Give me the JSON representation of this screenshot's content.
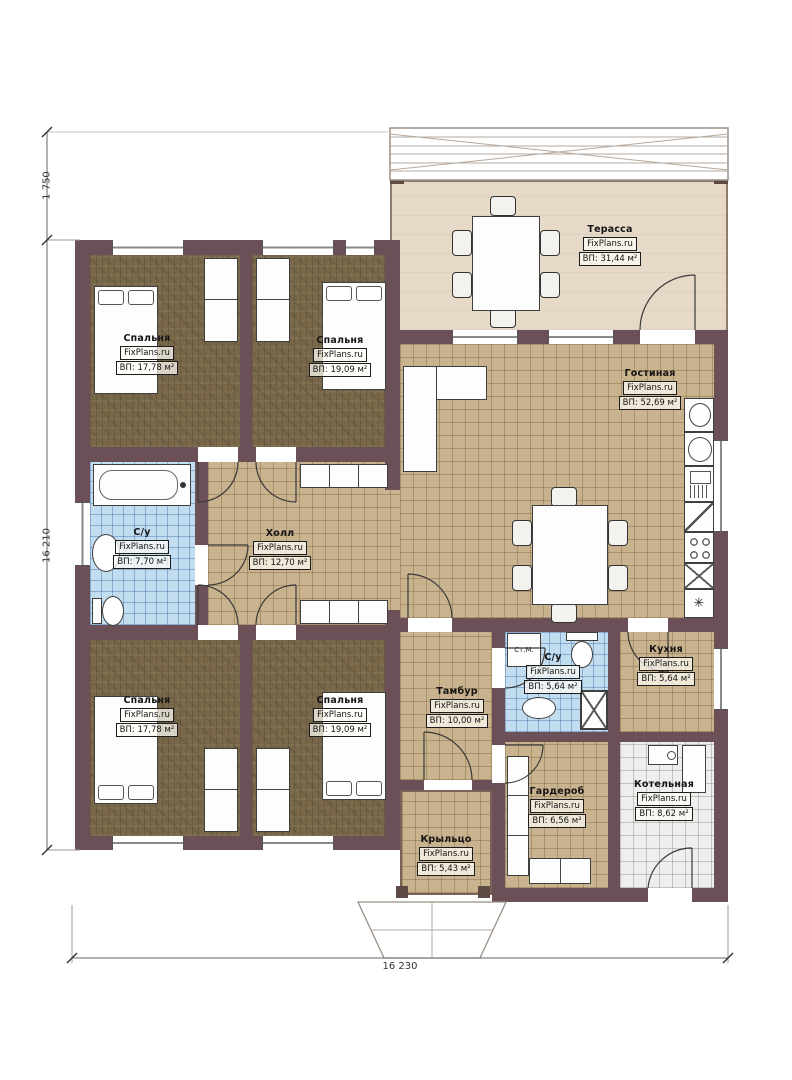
{
  "dimensions": {
    "left": "16 210",
    "top_left": "1 750",
    "bottom": "16 230"
  },
  "rooms": {
    "terrace": {
      "name": "Терасса",
      "brand": "FixPlans.ru",
      "area": "ВП: 31,44 м²"
    },
    "bedroom_tl": {
      "name": "Спальня",
      "brand": "FixPlans.ru",
      "area": "ВП: 17,78 м²"
    },
    "bedroom_tr": {
      "name": "Спальня",
      "brand": "FixPlans.ru",
      "area": "ВП: 19,09 м²"
    },
    "living": {
      "name": "Гостиная",
      "brand": "FixPlans.ru",
      "area": "ВП: 52,69 м²"
    },
    "bath_main": {
      "name": "С/у",
      "brand": "FixPlans.ru",
      "area": "ВП: 7,70 м²"
    },
    "hall": {
      "name": "Холл",
      "brand": "FixPlans.ru",
      "area": "ВП: 12,70 м²"
    },
    "kitchen": {
      "name": "Кухня",
      "brand": "FixPlans.ru",
      "area": "ВП: 5,64 м²"
    },
    "bath_small": {
      "name": "С/у",
      "brand": "FixPlans.ru",
      "area": "ВП: 5,64 м²"
    },
    "tambour": {
      "name": "Тамбур",
      "brand": "FixPlans.ru",
      "area": "ВП: 10,00 м²"
    },
    "bedroom_bl": {
      "name": "Спальня",
      "brand": "FixPlans.ru",
      "area": "ВП: 17,78 м²"
    },
    "bedroom_br": {
      "name": "Спальня",
      "brand": "FixPlans.ru",
      "area": "ВП: 19,09 м²"
    },
    "wardrobe": {
      "name": "Гардероб",
      "brand": "FixPlans.ru",
      "area": "ВП: 6,56 м²"
    },
    "boiler": {
      "name": "Котельная",
      "brand": "FixPlans.ru",
      "area": "ВП: 8,62 м²"
    },
    "porch": {
      "name": "Крыльцо",
      "brand": "FixPlans.ru",
      "area": "ВП: 5,43 м²"
    }
  },
  "annotations": {
    "washing_machine": "Ст.М.",
    "vent_symbol": "✳"
  },
  "colors": {
    "wall": "#6b5057",
    "floor_wood": "#786849",
    "floor_tile": "#c9b28e",
    "floor_bath": "#c2dcf0",
    "floor_terrace": "#e6d9c7",
    "floor_white_tile": "#efeeec"
  }
}
